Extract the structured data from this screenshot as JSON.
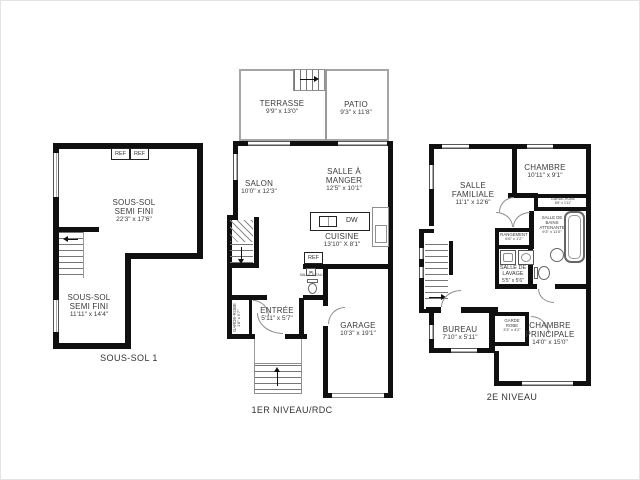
{
  "image": {
    "kind": "real-estate floor plan sheet, 3 levels",
    "background": "#ffffff",
    "wall_color": "#101010",
    "thin_line_color": "#9a9a9a",
    "text_color": "#3b3b3b"
  },
  "plans": {
    "basement": {
      "title": "SOUS-SOL 1",
      "rooms": {
        "semi_fini_haut": {
          "name": "SOUS-SOL\nSEMI FINI",
          "dim": "22'3\" x 17'6\""
        },
        "semi_fini_bas": {
          "name": "SOUS-SOL\nSEMI FINI",
          "dim": "11'11\" x 14'4\""
        }
      },
      "labels": {
        "ref1": "REF",
        "ref2": "REF"
      }
    },
    "main": {
      "title": "1ER NIVEAU/RDC",
      "rooms": {
        "terrasse": {
          "name": "TERRASSE",
          "dim": "9'9\" x 13'0\""
        },
        "patio": {
          "name": "PATIO",
          "dim": "9'3\" x 11'8\""
        },
        "salon": {
          "name": "SALON",
          "dim": "10'0\" x 12'3\""
        },
        "salle_a_manger": {
          "name": "SALLE À\nMANGER",
          "dim": "12'5\" x 10'1\""
        },
        "cuisine": {
          "name": "CUISINE",
          "dim": "13'10\" X 8'1\""
        },
        "entree": {
          "name": "ENTRÉE",
          "dim": "5'11\" x 5'7\""
        },
        "garage": {
          "name": "GARAGE",
          "dim": "10'3\" x 19'1\""
        },
        "garde_robe": {
          "name": "GARDE-ROBE",
          "dim": "1'8\" x 5'7\""
        },
        "salle_deau": {
          "name": "SALLE D'EAU",
          "dim": ""
        }
      },
      "labels": {
        "dw": "DW",
        "ref": "REF"
      }
    },
    "upper": {
      "title": "2E NIVEAU",
      "rooms": {
        "salle_familiale": {
          "name": "SALLE\nFAMILIALE",
          "dim": "11'1\" x 12'6\""
        },
        "chambre": {
          "name": "CHAMBRE",
          "dim": "10'11\" x 9'1\""
        },
        "garde_robe_chambre": {
          "name": "GARDE-ROBE",
          "dim": "8'8\" x 1'11\""
        },
        "salle_de_bains": {
          "name": "SALLE DE\nBAINS\nATTENANTE",
          "dim": "9'3\" x 11'0\""
        },
        "rangement": {
          "name": "RANGEMENT",
          "dim": "6'6\" x 1'2\""
        },
        "salle_de_lavage": {
          "name": "SALLE DE\nLAVAGE",
          "dim": "5'5\" x 5'6\""
        },
        "bureau": {
          "name": "BUREAU",
          "dim": "7'10\" x 5'11\""
        },
        "garde_robe_principale": {
          "name": "GARDE\nROBE",
          "dim": "3'3\" x 4'2\""
        },
        "chambre_principale": {
          "name": "CHAMBRE\nPRINCIPALE",
          "dim": "14'0\" x 15'0\""
        }
      }
    }
  }
}
